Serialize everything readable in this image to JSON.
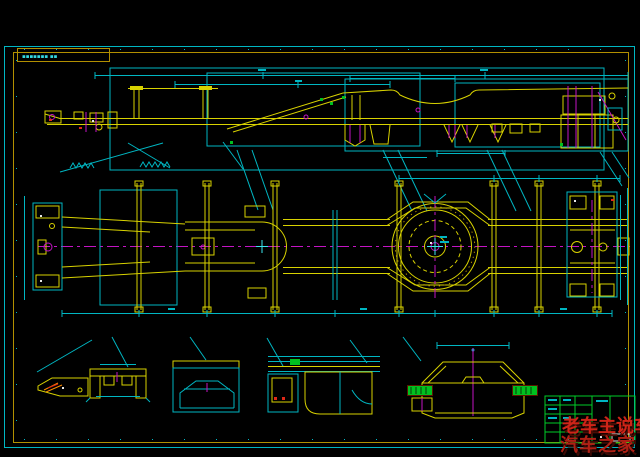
{
  "sheet": {
    "label_box_text": "▪▪▪▪▪▪▪ ▪▪",
    "background": "#000000",
    "border_outer_color": "#00b6c2",
    "border_inner_color": "#b28f00"
  },
  "drawing": {
    "line_colors": {
      "cyan": "#00b6c2",
      "yellow": "#d8d200",
      "magenta": "#c414c4",
      "green": "#00cc28",
      "orange": "#ff8c00",
      "red": "#e02818",
      "white": "#e0e0e0"
    },
    "views": {
      "top": "side-elevation-of-trailer-chassis",
      "middle": "plan-view-with-turntable-ring",
      "bottom": "cross-section-details"
    }
  },
  "watermark": {
    "line1": "老车主说车",
    "line2": "汽车之家",
    "color": "#cf2418"
  }
}
